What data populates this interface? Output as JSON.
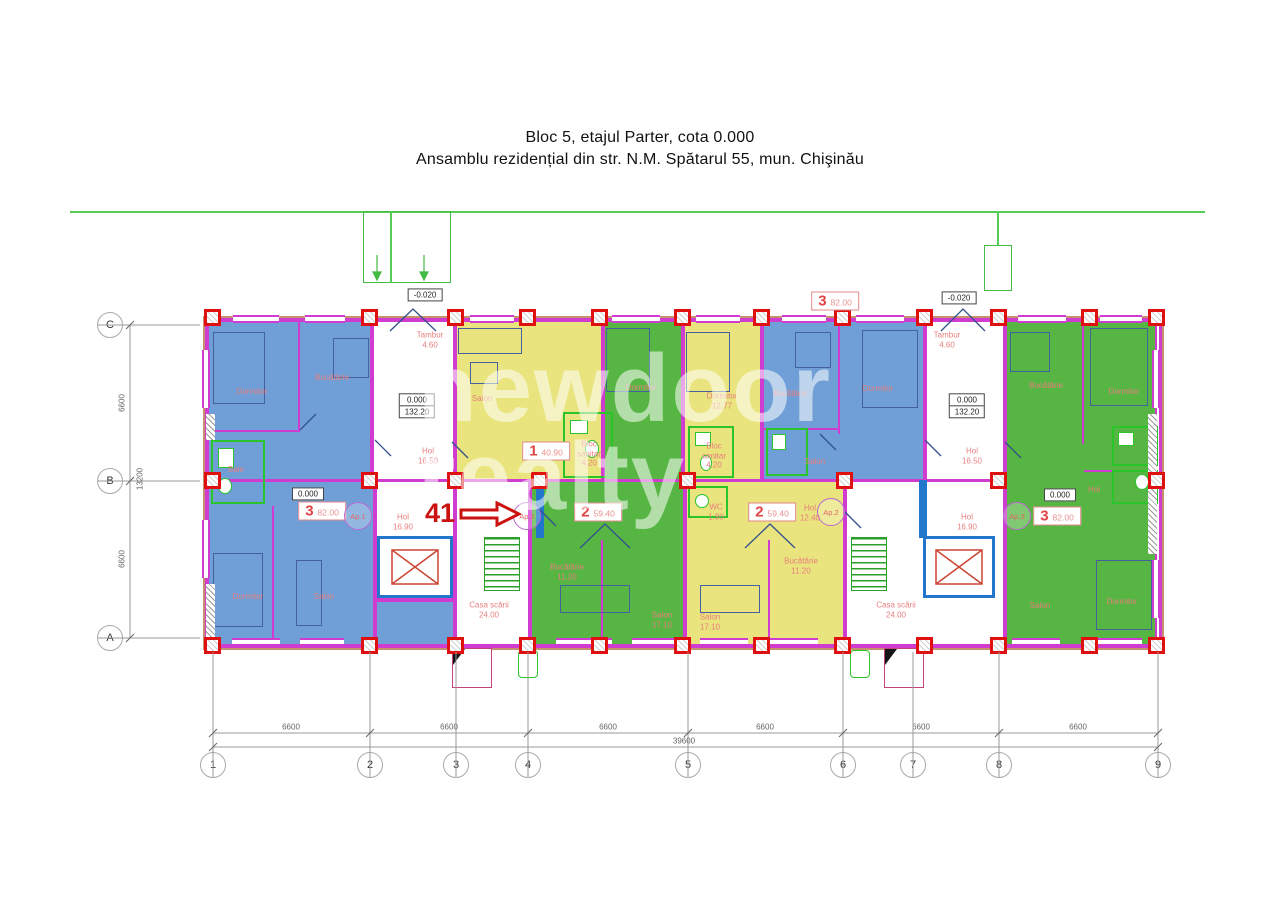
{
  "title": {
    "line1": "Bloc 5, etajul Parter, cota 0.000",
    "line2": "Ansamblu rezidențial din str. N.M. Spătarul 55, mun. Chişinău"
  },
  "watermark": {
    "line1": "newdoor",
    "line2": "realty"
  },
  "annotation": {
    "unit_number": "41"
  },
  "levels": {
    "ground": "0.000",
    "plate": "132.20",
    "entry": "-0.020"
  },
  "halls": {
    "tambur": "Tambur",
    "tambur_area": "4.60",
    "hol": "Hol",
    "hol_upper_area": "16.50",
    "hol_lower_area": "16.90",
    "stair": "Casa scării",
    "stair_area": "24.00"
  },
  "apartments": {
    "a_blue_left": {
      "num": "3",
      "area": "82.00",
      "badge": "Ap.1"
    },
    "a_yellow_small": {
      "num": "1",
      "area": "40.90"
    },
    "a_green_mid": {
      "num": "2",
      "area": "59.40",
      "badge": "Ap.2"
    },
    "a_yellow_mid": {
      "num": "2",
      "area": "59.40",
      "badge": "Ap.2"
    },
    "a_blue_mid": {
      "num": "3",
      "area": "82.00"
    },
    "a_green_right": {
      "num": "3",
      "area": "82.00",
      "badge": "Ap.3"
    }
  },
  "rooms": {
    "dormitor": "Dormitor",
    "bucatarie": "Bucătărie",
    "salon": "Salon",
    "baie": "Baie",
    "hol": "Hol",
    "wc": "WC",
    "bloc": "Bloc",
    "sanitar": "sanitar"
  },
  "areas": {
    "bloc_sanitar": "4.20",
    "wc": "1.80",
    "hol_mid": "12.40",
    "bucatarie": "11.20",
    "salon": "17.10",
    "dormitor": "12.77"
  },
  "axes": {
    "cols": [
      "1",
      "2",
      "3",
      "4",
      "5",
      "6",
      "7",
      "8",
      "9"
    ],
    "rows": [
      "C",
      "B",
      "A"
    ],
    "h_dims": [
      "6600",
      "6600",
      "6600",
      "6600",
      "6600",
      "6600"
    ],
    "h_total": "39600",
    "v_dims": [
      "6600",
      "6600"
    ],
    "v_total": "13200"
  }
}
